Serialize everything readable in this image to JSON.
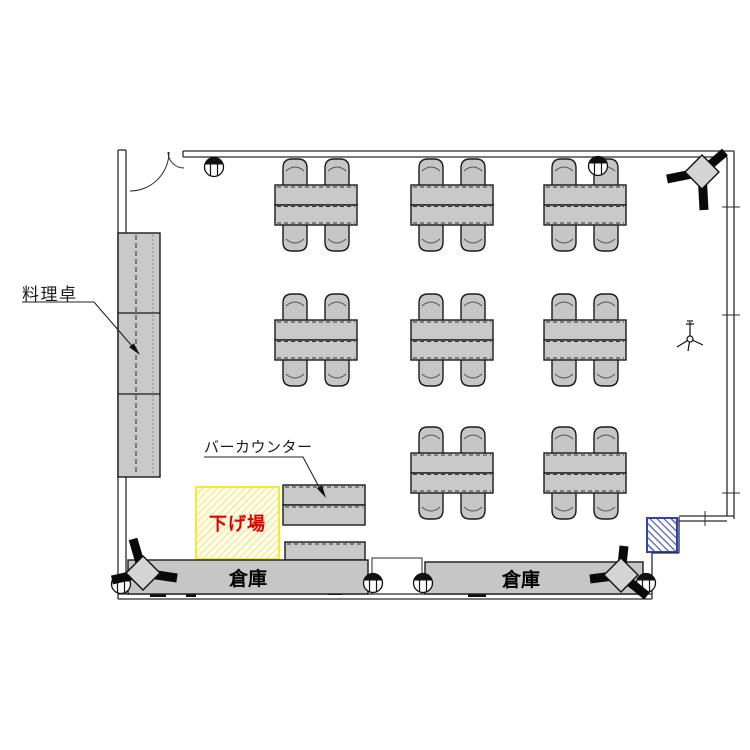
{
  "floorplan": {
    "labels": {
      "cooking_table": "料理卓",
      "bar_counter": "バーカウンター",
      "clearing_area": "下げ場",
      "storage_left": "倉庫",
      "storage_right": "倉庫"
    },
    "colors": {
      "furniture_fill": "#c9c9c9",
      "outline": "#1a1a1a",
      "clearing_border": "#f0ee2a",
      "clearing_hatch": "#f1ea9a",
      "clearing_text": "#e00000",
      "blue_panel_border": "#3240b5",
      "blue_panel_hatch": "#6672c8"
    },
    "tables": [
      {
        "x": 275,
        "y": 185
      },
      {
        "x": 411,
        "y": 185
      },
      {
        "x": 544,
        "y": 185
      },
      {
        "x": 275,
        "y": 320
      },
      {
        "x": 411,
        "y": 320
      },
      {
        "x": 544,
        "y": 320
      },
      {
        "x": 411,
        "y": 453
      },
      {
        "x": 544,
        "y": 453
      }
    ],
    "table_size": {
      "w": 82,
      "h": 40,
      "chair_w": 24,
      "chair_h": 28,
      "chair_offsets": [
        8,
        50
      ]
    },
    "cabinet": {
      "x": 118,
      "y": 233,
      "w": 42,
      "h": 244,
      "dividers": [
        313,
        394
      ]
    },
    "bar_counter_blocks": [
      {
        "x": 283,
        "y": 485,
        "w": 82,
        "h": 20
      },
      {
        "x": 283,
        "y": 505,
        "w": 82,
        "h": 20
      },
      {
        "x": 285,
        "y": 542,
        "w": 80,
        "h": 18
      }
    ],
    "storages": [
      {
        "x": 128,
        "y": 560,
        "w": 240,
        "h": 34,
        "tx": 248,
        "ty": 585
      },
      {
        "x": 425,
        "y": 562,
        "w": 218,
        "h": 32,
        "tx": 521,
        "ty": 586
      }
    ],
    "circles": [
      {
        "cx": 214,
        "cy": 167
      },
      {
        "cx": 598,
        "cy": 166
      },
      {
        "cx": 121,
        "cy": 584
      },
      {
        "cx": 373,
        "cy": 583
      },
      {
        "cx": 423,
        "cy": 583
      },
      {
        "cx": 646,
        "cy": 583
      }
    ],
    "speakers": [
      {
        "cx": 702,
        "cy": 172,
        "arms": [
          [
            667,
            179
          ],
          [
            725,
            152
          ],
          [
            704,
            210
          ]
        ]
      },
      {
        "cx": 143,
        "cy": 573,
        "arms": [
          [
            133,
            539
          ],
          [
            112,
            580
          ],
          [
            177,
            578
          ]
        ]
      },
      {
        "cx": 621,
        "cy": 575,
        "arms": [
          [
            590,
            579
          ],
          [
            624,
            546
          ],
          [
            647,
            596
          ]
        ]
      }
    ]
  }
}
